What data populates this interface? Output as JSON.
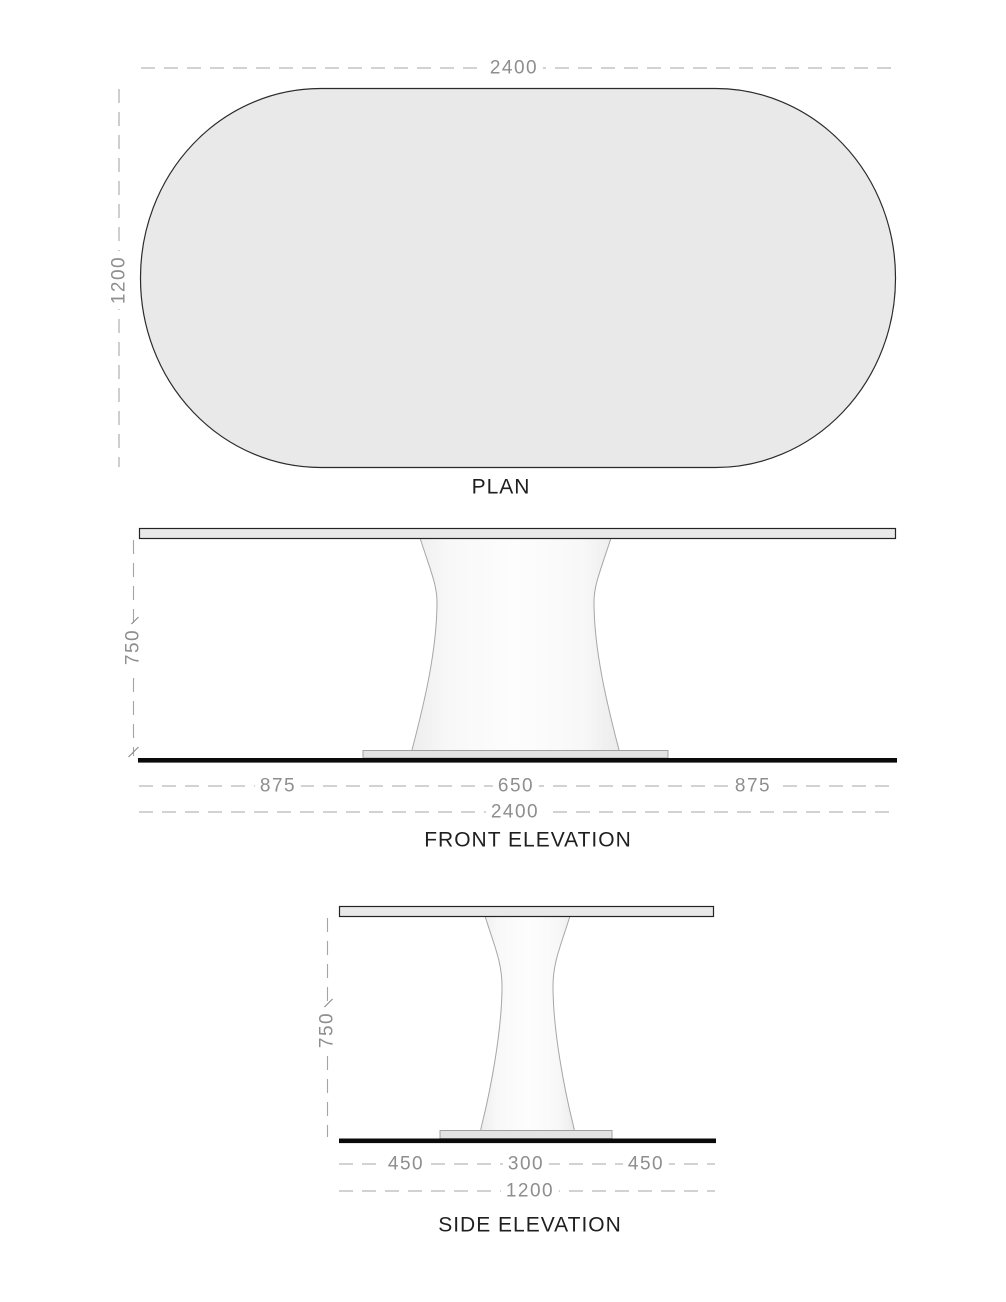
{
  "plan": {
    "title": "PLAN",
    "width_dim": "2400",
    "depth_dim": "1200"
  },
  "front_elevation": {
    "title": "FRONT ELEVATION",
    "height_dim": "750",
    "left_overhang_dim": "875",
    "pedestal_base_dim": "650",
    "right_overhang_dim": "875",
    "overall_width_dim": "2400"
  },
  "side_elevation": {
    "title": "SIDE ELEVATION",
    "height_dim": "750",
    "left_overhang_dim": "450",
    "pedestal_base_dim": "300",
    "right_overhang_dim": "450",
    "overall_width_dim": "1200"
  },
  "colors": {
    "surface_fill": "#e9e9e9",
    "pedestal_fill": "#f8f8f8",
    "base_plate_fill": "#e3e3e3",
    "outline": "#242424",
    "floor_line": "#0a0a0a",
    "dimension_text": "#8e8e8e",
    "dimension_line": "#a5a5a5"
  }
}
